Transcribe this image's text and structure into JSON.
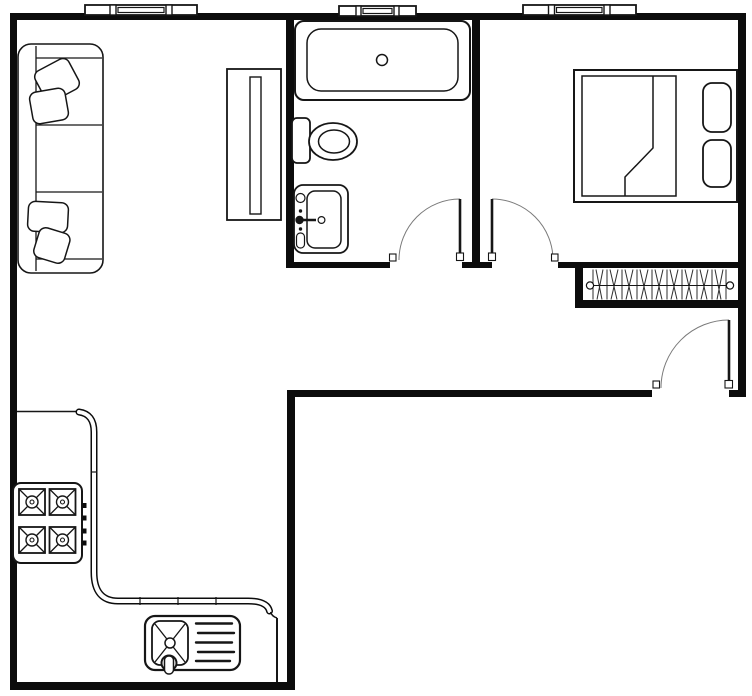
{
  "document": {
    "type": "apartment-floor-plan",
    "canvas": {
      "width": 752,
      "height": 696
    },
    "colors": {
      "background": "#ffffff",
      "walls": "#0c0c0c",
      "fixture_lines": "#161616",
      "door_swing_arcs": "#7a7a7a"
    }
  },
  "rooms": [
    {
      "id": "living-room",
      "position": "top-left",
      "fixtures": [
        "sofa-3-seat",
        "throw-pillow-x4",
        "media-cabinet",
        "window"
      ]
    },
    {
      "id": "bathroom",
      "position": "top-middle",
      "fixtures": [
        "bathtub",
        "toilet",
        "vanity-sink",
        "window",
        "swing-door"
      ]
    },
    {
      "id": "bedroom",
      "position": "top-right",
      "fixtures": [
        "double-bed",
        "bed-pillow-x2",
        "folded-blanket",
        "window",
        "swing-door"
      ]
    },
    {
      "id": "hall",
      "position": "middle-right",
      "fixtures": [
        "closet-with-hanger-rod",
        "entry-swing-door"
      ]
    },
    {
      "id": "kitchen",
      "position": "bottom-left",
      "fixtures": [
        "l-shaped-counter",
        "stove-4-burner",
        "sink-with-drainboard"
      ]
    }
  ],
  "symbols": {
    "window-icon": "triple-pane-window-in-wall",
    "door-icon": "leaf-with-quarter-circle-swing-arc",
    "closet-icon": "zigzag-hanger-hatching-with-rod",
    "burner-icon": "square-with-x-and-center-ring",
    "sink-icon": "basin-with-x-drain-and-faucet",
    "bathtub-icon": "double-outline-tub-with-drain",
    "toilet-icon": "tank-and-oval-bowl",
    "sofa-icon": "top-view-sofa-with-cushions",
    "bed-icon": "top-view-bed-with-pillows"
  },
  "counts": {
    "windows": 3,
    "interior-doors": 2,
    "entry-doors": 1,
    "stove-burners": 4,
    "sofa-pillows": 4,
    "bed-pillows": 2
  }
}
